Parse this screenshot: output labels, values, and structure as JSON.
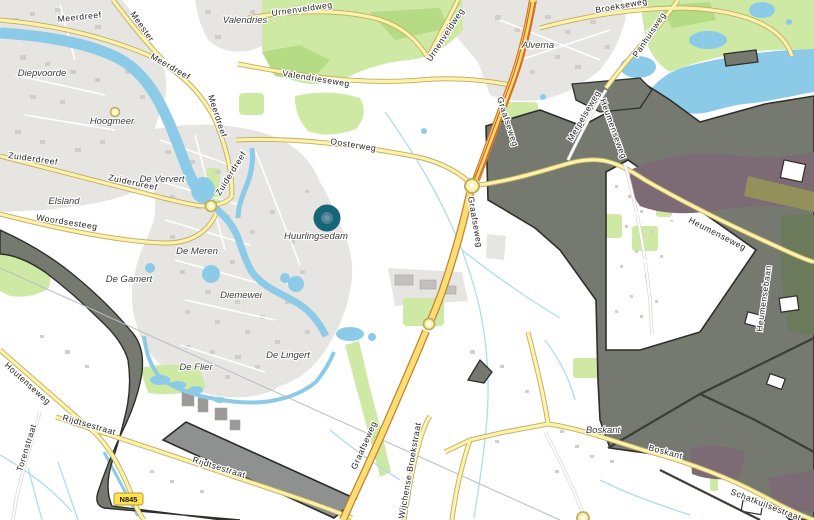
{
  "map": {
    "marker": {
      "label": "Huurlingsedam"
    },
    "shield": {
      "text": "N845"
    },
    "road_labels": [
      "Meerdreef",
      "Meerdreef",
      "Meerdreef",
      "Meester",
      "Urnenveldweg",
      "Urnenveldweg",
      "Valendrieseweg",
      "Oosterweg",
      "Graafseweg",
      "Graafseweg",
      "Graafseweg",
      "Zuiderdreef",
      "Zuiderdreef",
      "Zuiderdreef",
      "Woordsesteeg",
      "Heumenseweg",
      "Heumenseweg",
      "Merpelseweg",
      "Panhuisweg",
      "Broekseweg",
      "Rijdtsestraat",
      "Rijdtsestraat",
      "Torenstraat",
      "Houtenseweg",
      "Wijchense Broekstraat",
      "Boskant",
      "Schatkuilsestraat",
      "Heumensebaan"
    ],
    "place_labels": [
      "Diepvoorde",
      "Hoogmeer",
      "Valendries",
      "Alverna",
      "De Ververt",
      "Elsland",
      "De Meren",
      "De Gamert",
      "Diemewei",
      "Huurlingsedam",
      "De Lingert",
      "De Flier",
      "Boskant"
    ],
    "colors": {
      "water": "#8ccbe8",
      "road_minor": "#fdf2ab",
      "road_major": "#f8df75",
      "road_major_accent": "#dd5f28",
      "overlay_gray": "#75796f",
      "overlay_purple": "#7c6b75",
      "green": "#cde9a4",
      "urban": "#e6e5e2",
      "marker_teal": "#176579",
      "shield_yellow": "#fde24e"
    }
  }
}
